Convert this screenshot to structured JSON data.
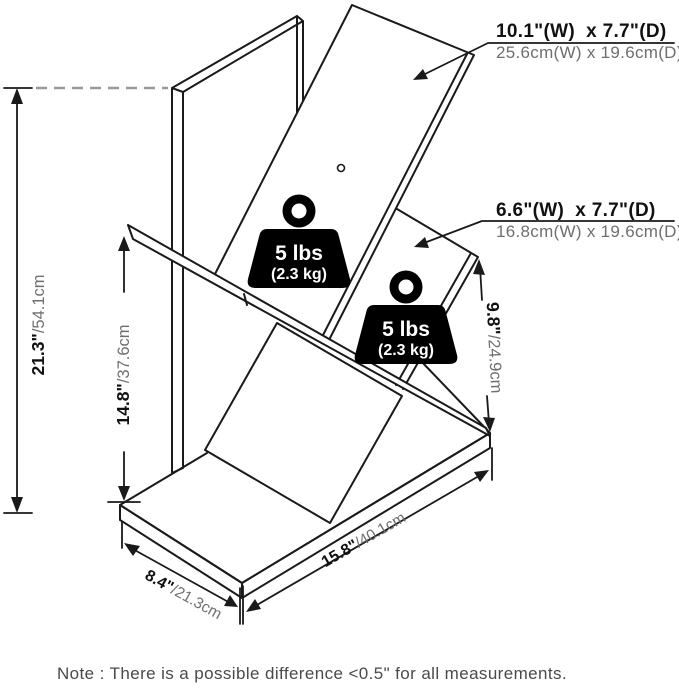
{
  "diagram": {
    "product_labels": {
      "top_shelf": {
        "inches": "10.1\"(W)  x 7.7\"(D)",
        "metric": "25.6cm(W) x 19.6cm(D)"
      },
      "lower_shelf": {
        "inches": "6.6\"(W)  x 7.7\"(D)",
        "metric": "16.8cm(W) x 19.6cm(D)"
      }
    },
    "dimensions": {
      "total_height": {
        "inches": "21.3\"",
        "metric": "/54.1cm"
      },
      "shelf_height": {
        "inches": "14.8\"",
        "metric": "/37.6cm"
      },
      "right_height": {
        "inches": "9.8\"",
        "metric": "/24.9cm"
      },
      "depth": {
        "inches": "8.4\"",
        "metric": "/21.3cm"
      },
      "width": {
        "inches": "15.8\"",
        "metric": "/40.1cm"
      }
    },
    "weight_capacity": {
      "pounds": "5 lbs",
      "kilograms": "(2.3 kg)"
    },
    "note": "Note : There is a possible difference <0.5\" for all measurements.",
    "colors": {
      "line": "#1a1a1a",
      "metric_text": "#6f6f6f",
      "note_text": "#4a4a4a",
      "weight_badge": "#000000",
      "weight_text": "#ffffff",
      "dashed_line": "#999999",
      "background": "#ffffff"
    }
  }
}
